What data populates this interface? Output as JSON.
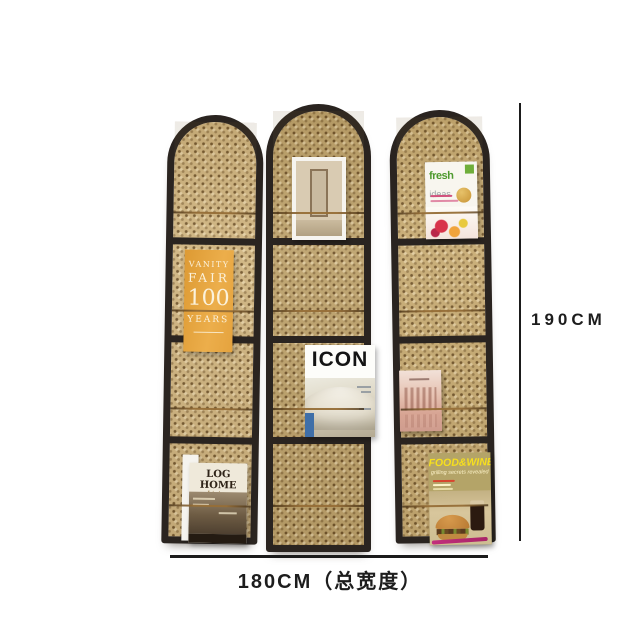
{
  "annotations": {
    "height_label": "190CM",
    "width_label": "180CM（总宽度）"
  },
  "magazines": {
    "vanity_fair": {
      "lines": [
        "VANITY",
        "FAIR",
        "100",
        "YEARS"
      ]
    },
    "log_home": {
      "title": "LOG HOME",
      "subtitle": "Living"
    },
    "icon": {
      "title": "ICON"
    },
    "fresh_ideas": {
      "word1": "fresh",
      "word2": "ideas"
    },
    "food_wine": {
      "title": "FOOD&WINE",
      "subtitle": "grilling secrets revealed"
    }
  },
  "colors": {
    "background": "#ffffff",
    "frame_black": "#2a2420",
    "cane_tan": "#c9ad77",
    "wire_brass": "#966e37",
    "dimension_line": "#1b1b1b",
    "vanity_orange": "#e8a43e",
    "fresh_green": "#4e9a2e",
    "foodwine_yellow": "#f6df1e"
  }
}
